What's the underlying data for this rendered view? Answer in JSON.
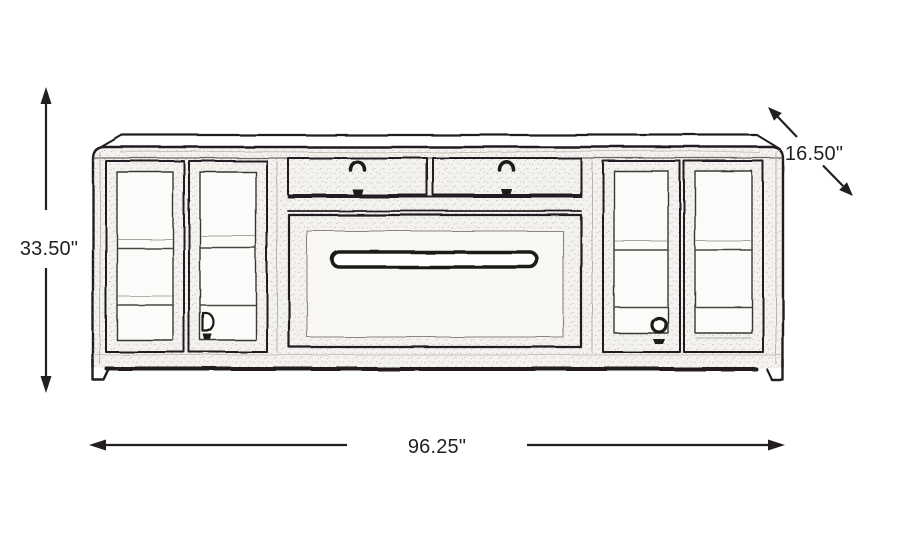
{
  "diagram": {
    "subject": "media console dimension drawing",
    "ink_color": "#231f20",
    "dimensions": {
      "height": "33.50\"",
      "depth": "16.50\"",
      "width": "96.25\""
    },
    "icons": {
      "height_arrow": "double-arrow-vertical",
      "width_arrow": "double-arrow-horizontal",
      "depth_arrow": "double-arrow-diagonal"
    }
  }
}
